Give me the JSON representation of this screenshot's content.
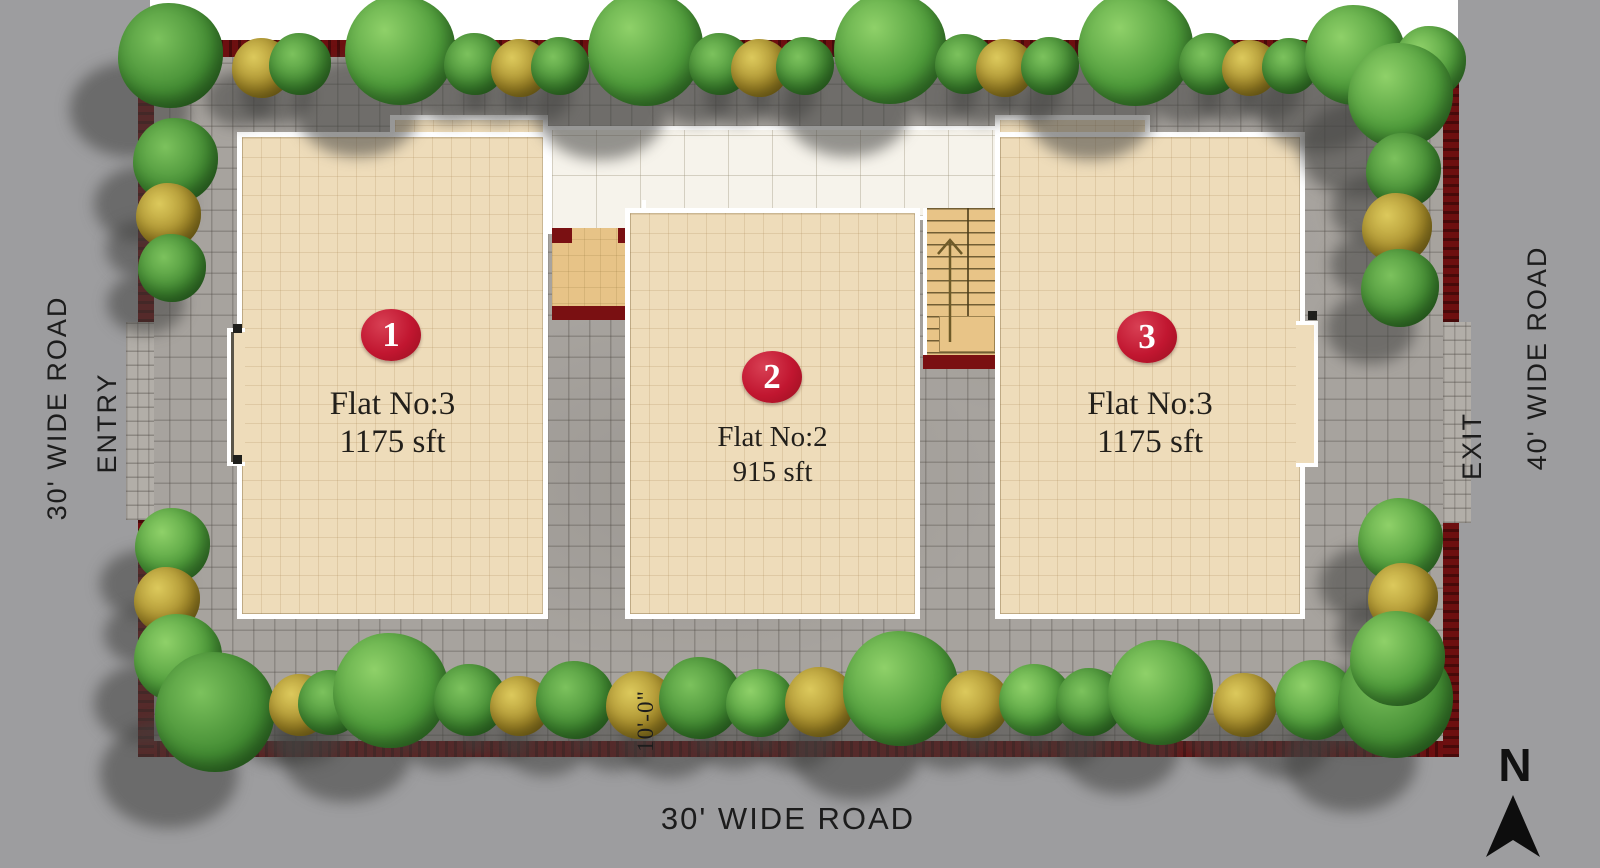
{
  "plan": {
    "flats": [
      {
        "badge": "1",
        "label": "Flat No:3",
        "area": "1175 sft"
      },
      {
        "badge": "2",
        "label": "Flat No:2",
        "area": "915 sft"
      },
      {
        "badge": "3",
        "label": "Flat No:3",
        "area": "1175 sft"
      }
    ],
    "roads": {
      "left_label": "30' WIDE ROAD",
      "left_entry": "ENTRY",
      "bottom_label": "30' WIDE ROAD",
      "right_label": "40' WIDE ROAD",
      "right_exit": "EXIT"
    },
    "dimension_setback": "10'-0\"",
    "compass_label": "N"
  },
  "colors": {
    "road": "#9d9d9f",
    "site_paving": "#a7a39e",
    "boundary_wall": "#6d0f10",
    "block_fill": "#eedcba",
    "walkway": "#f6f3eb",
    "stair": "#e8c487",
    "badge_red": "#c11630",
    "text_dark": "#1c1c1c"
  },
  "landscape": {
    "trees": [
      {
        "x": 170,
        "y": 55,
        "d": 105,
        "t": "g"
      },
      {
        "x": 262,
        "y": 68,
        "d": 60,
        "t": "y"
      },
      {
        "x": 300,
        "y": 64,
        "d": 62,
        "t": "g"
      },
      {
        "x": 400,
        "y": 50,
        "d": 110,
        "t": "g"
      },
      {
        "x": 475,
        "y": 64,
        "d": 62,
        "t": "g"
      },
      {
        "x": 520,
        "y": 68,
        "d": 58,
        "t": "y"
      },
      {
        "x": 560,
        "y": 66,
        "d": 58,
        "t": "g"
      },
      {
        "x": 645,
        "y": 48,
        "d": 115,
        "t": "g"
      },
      {
        "x": 720,
        "y": 64,
        "d": 62,
        "t": "g"
      },
      {
        "x": 760,
        "y": 68,
        "d": 58,
        "t": "y"
      },
      {
        "x": 805,
        "y": 66,
        "d": 58,
        "t": "g"
      },
      {
        "x": 890,
        "y": 48,
        "d": 112,
        "t": "g"
      },
      {
        "x": 965,
        "y": 64,
        "d": 60,
        "t": "g"
      },
      {
        "x": 1005,
        "y": 68,
        "d": 58,
        "t": "y"
      },
      {
        "x": 1050,
        "y": 66,
        "d": 58,
        "t": "g"
      },
      {
        "x": 1135,
        "y": 48,
        "d": 115,
        "t": "g"
      },
      {
        "x": 1210,
        "y": 64,
        "d": 62,
        "t": "g"
      },
      {
        "x": 1250,
        "y": 68,
        "d": 56,
        "t": "y"
      },
      {
        "x": 1290,
        "y": 66,
        "d": 56,
        "t": "g"
      },
      {
        "x": 1355,
        "y": 55,
        "d": 100,
        "t": "g"
      },
      {
        "x": 1408,
        "y": 70,
        "d": 55,
        "t": "y"
      },
      {
        "x": 1430,
        "y": 62,
        "d": 72,
        "t": "g"
      },
      {
        "x": 175,
        "y": 160,
        "d": 85,
        "t": "g"
      },
      {
        "x": 168,
        "y": 215,
        "d": 65,
        "t": "y"
      },
      {
        "x": 172,
        "y": 268,
        "d": 68,
        "t": "g"
      },
      {
        "x": 172,
        "y": 545,
        "d": 75,
        "t": "g"
      },
      {
        "x": 167,
        "y": 600,
        "d": 66,
        "t": "y"
      },
      {
        "x": 178,
        "y": 658,
        "d": 88,
        "t": "g"
      },
      {
        "x": 215,
        "y": 712,
        "d": 120,
        "t": "g"
      },
      {
        "x": 300,
        "y": 705,
        "d": 62,
        "t": "y"
      },
      {
        "x": 330,
        "y": 702,
        "d": 65,
        "t": "g"
      },
      {
        "x": 390,
        "y": 690,
        "d": 115,
        "t": "g"
      },
      {
        "x": 470,
        "y": 700,
        "d": 72,
        "t": "g"
      },
      {
        "x": 520,
        "y": 706,
        "d": 60,
        "t": "y"
      },
      {
        "x": 575,
        "y": 700,
        "d": 78,
        "t": "g"
      },
      {
        "x": 640,
        "y": 705,
        "d": 68,
        "t": "y"
      },
      {
        "x": 700,
        "y": 698,
        "d": 82,
        "t": "g"
      },
      {
        "x": 760,
        "y": 703,
        "d": 68,
        "t": "g"
      },
      {
        "x": 820,
        "y": 702,
        "d": 70,
        "t": "y"
      },
      {
        "x": 900,
        "y": 688,
        "d": 115,
        "t": "g"
      },
      {
        "x": 975,
        "y": 704,
        "d": 68,
        "t": "y"
      },
      {
        "x": 1035,
        "y": 700,
        "d": 72,
        "t": "g"
      },
      {
        "x": 1090,
        "y": 702,
        "d": 68,
        "t": "g"
      },
      {
        "x": 1160,
        "y": 692,
        "d": 105,
        "t": "g"
      },
      {
        "x": 1245,
        "y": 705,
        "d": 64,
        "t": "y"
      },
      {
        "x": 1315,
        "y": 700,
        "d": 80,
        "t": "g"
      },
      {
        "x": 1395,
        "y": 700,
        "d": 115,
        "t": "g"
      },
      {
        "x": 1400,
        "y": 95,
        "d": 105,
        "t": "g"
      },
      {
        "x": 1403,
        "y": 170,
        "d": 75,
        "t": "g"
      },
      {
        "x": 1397,
        "y": 228,
        "d": 70,
        "t": "y"
      },
      {
        "x": 1400,
        "y": 288,
        "d": 78,
        "t": "g"
      },
      {
        "x": 1400,
        "y": 540,
        "d": 85,
        "t": "g"
      },
      {
        "x": 1403,
        "y": 598,
        "d": 70,
        "t": "y"
      },
      {
        "x": 1397,
        "y": 658,
        "d": 95,
        "t": "g"
      }
    ]
  }
}
